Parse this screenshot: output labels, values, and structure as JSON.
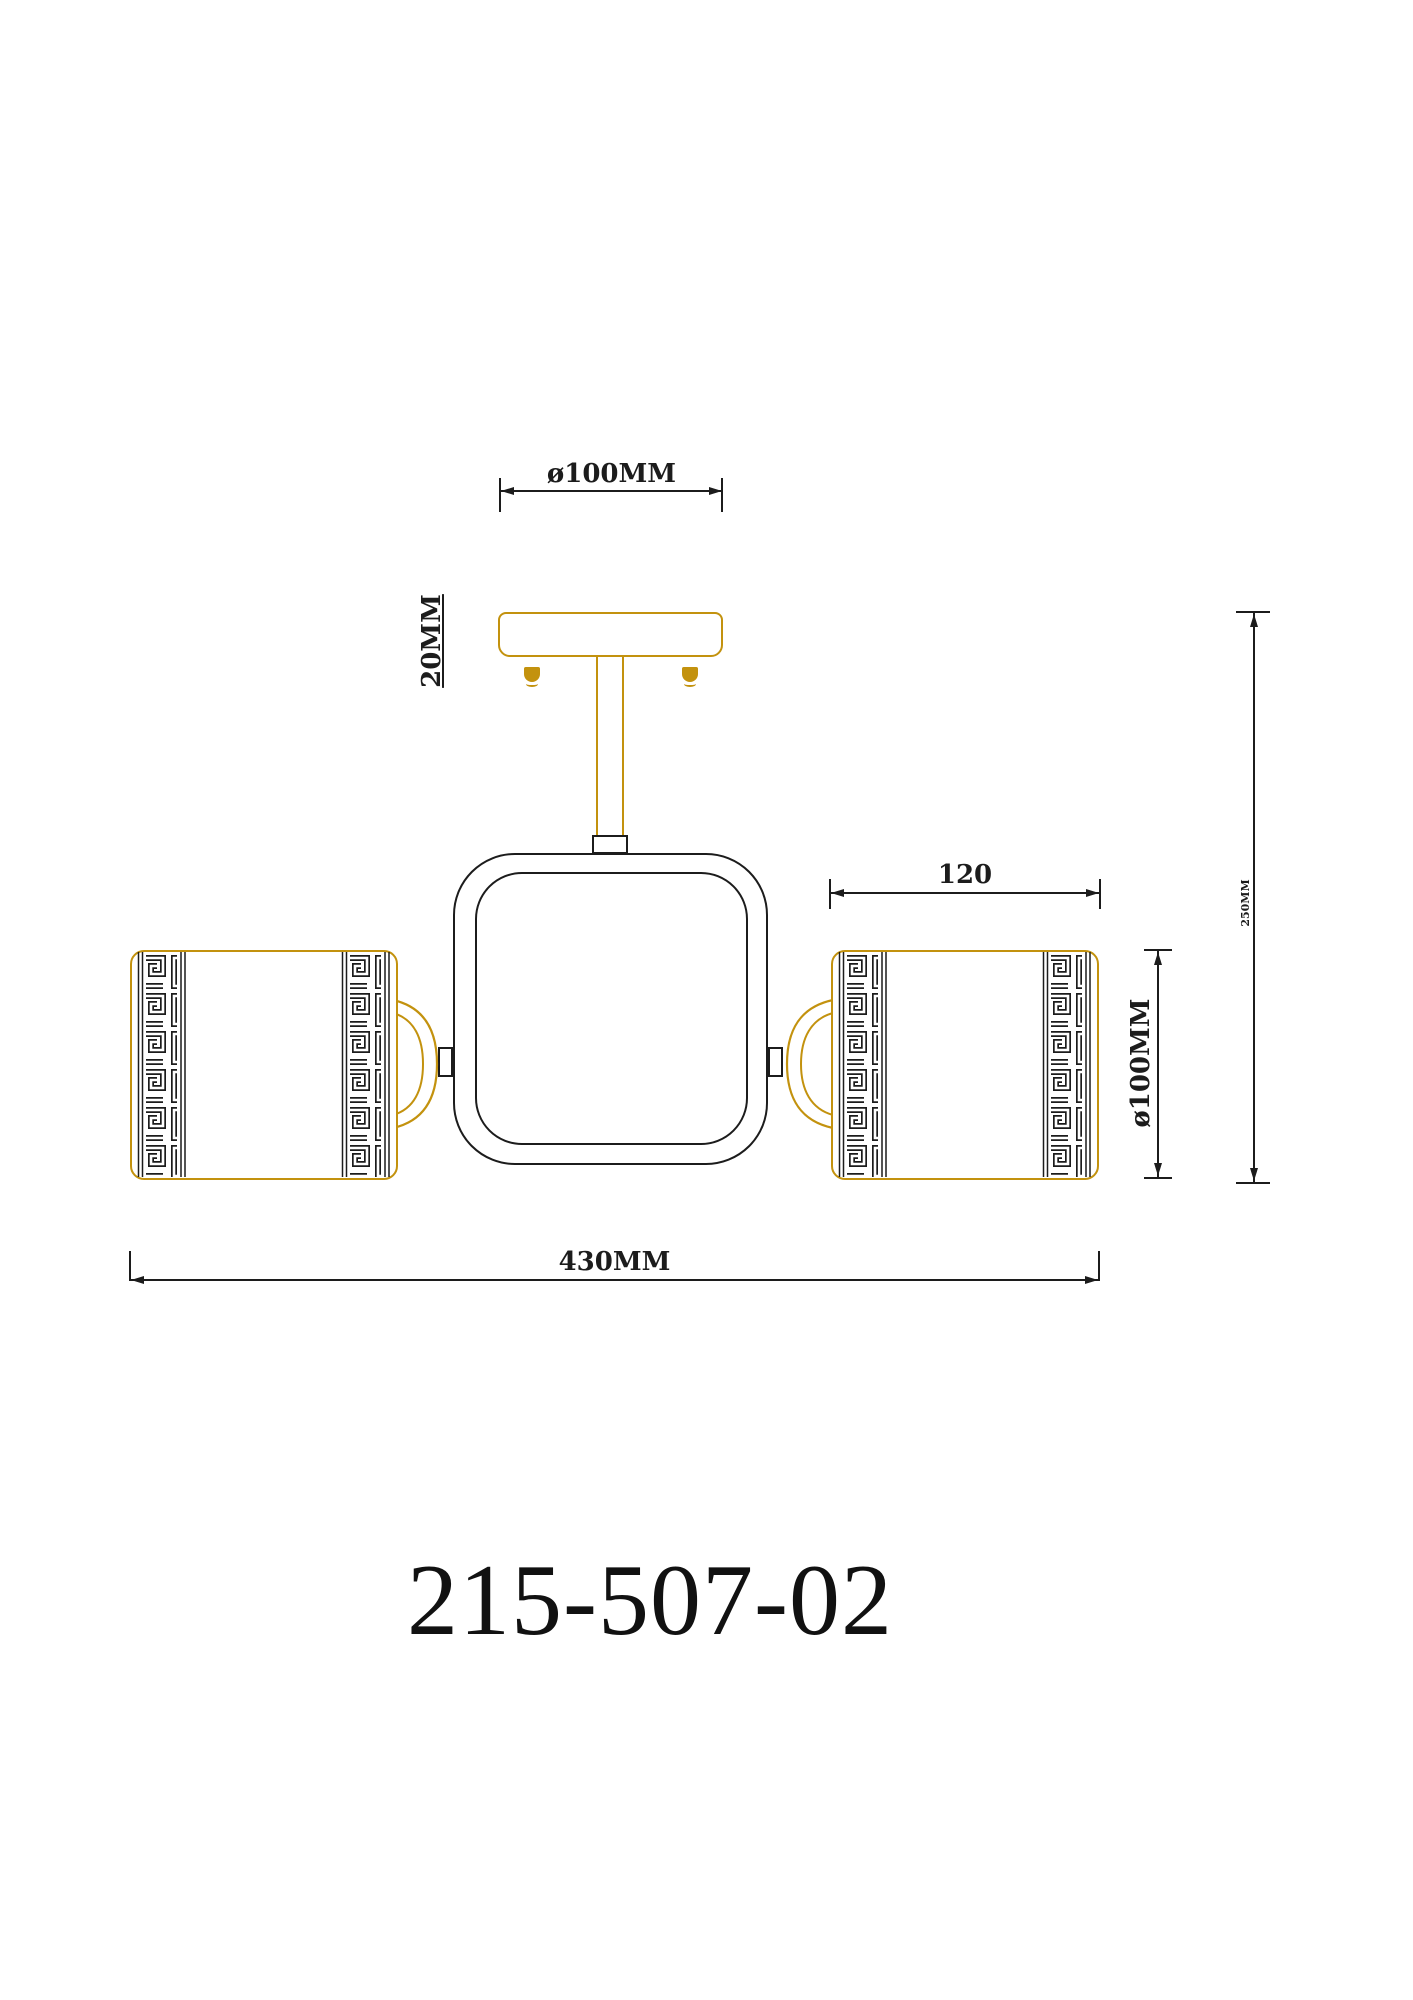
{
  "page": {
    "background": "#ffffff"
  },
  "drawing": {
    "kind": "ceiling-light-technical-drawing",
    "product_code": "215-507-02",
    "colors": {
      "gold": "#c3920e",
      "line": "#1c1c1c"
    },
    "dimensions": {
      "canopy_diameter": "ø100MM",
      "canopy_height": "20MM",
      "shade_width": "120",
      "shade_height": "ø100MM",
      "overall_width": "430MM",
      "overall_height": "250MM"
    }
  }
}
